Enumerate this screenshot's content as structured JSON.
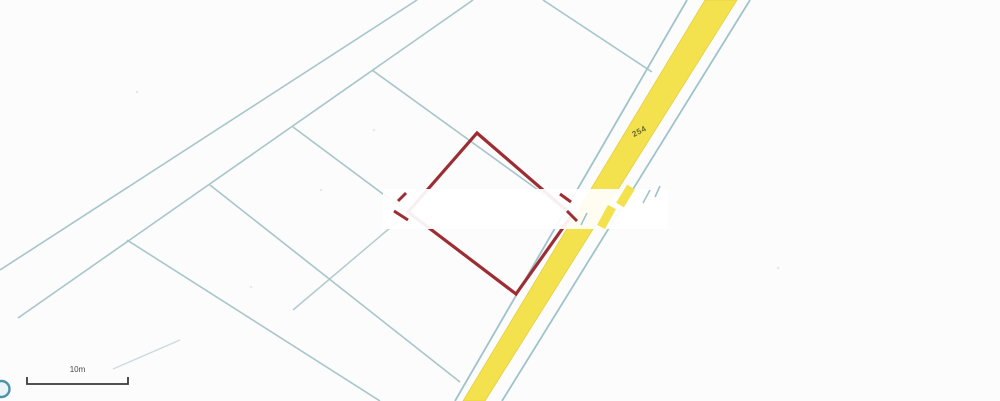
{
  "map": {
    "background": "#fcfcfc",
    "boundary_color": "#a4c3c8",
    "road": {
      "label": "254",
      "surface_color": "#F4E14E",
      "surface_edge_color": "#e4cf3c",
      "edge_line_color": "#9fc2cc",
      "surface_quad": [
        [
          705,
          0
        ],
        [
          737,
          0
        ],
        [
          485,
          401
        ],
        [
          463,
          401
        ]
      ],
      "left_edge_line": [
        687,
        0,
        455,
        401
      ],
      "right_edge_line": [
        750,
        0,
        502,
        401
      ]
    },
    "boundary_lines": [
      {
        "id": "long-parcel-line-1",
        "pts": [
          417,
          0,
          0,
          270
        ],
        "w": 1.6,
        "o": 0.95
      },
      {
        "id": "long-parcel-line-2",
        "pts": [
          473,
          0,
          18,
          318
        ],
        "w": 1.6,
        "o": 0.95
      },
      {
        "id": "long-parcel-line-2-fade",
        "pts": [
          180,
          340,
          113,
          369
        ],
        "w": 1.4,
        "o": 0.55
      },
      {
        "id": "divider-north",
        "pts": [
          543,
          0,
          652,
          72
        ],
        "w": 1.6,
        "o": 0.95
      },
      {
        "id": "divider-1",
        "pts": [
          372,
          70,
          563,
          208
        ],
        "w": 1.6,
        "o": 0.95
      },
      {
        "id": "divider-2",
        "pts": [
          293,
          127,
          516,
          293
        ],
        "w": 1.6,
        "o": 0.95
      },
      {
        "id": "divider-3",
        "pts": [
          210,
          185,
          460,
          382
        ],
        "w": 1.6,
        "o": 0.95
      },
      {
        "id": "divider-4",
        "pts": [
          127,
          240,
          380,
          401
        ],
        "w": 1.6,
        "o": 0.95
      },
      {
        "id": "cross-segment",
        "pts": [
          397,
          222,
          293,
          310
        ],
        "w": 1.5,
        "o": 0.85
      }
    ],
    "highlight_parcel": {
      "color": "#9C2E33",
      "stroke_width": 3.2,
      "points": "477,133 572,215 516,294 408,212"
    },
    "erasure_band": {
      "x": 383,
      "y": 189,
      "w": 285,
      "h": 40,
      "color": "#ffffff",
      "opacity": 0.93
    },
    "fragments": [
      {
        "color": "#9C2E33",
        "pts": [
          398,
          201,
          406,
          193
        ],
        "w": 3
      },
      {
        "color": "#9C2E33",
        "pts": [
          394,
          211,
          408,
          220
        ],
        "w": 3
      },
      {
        "color": "#9C2E33",
        "pts": [
          560,
          194,
          571,
          202
        ],
        "w": 3
      },
      {
        "color": "#9C2E33",
        "pts": [
          567,
          211,
          577,
          221
        ],
        "w": 3
      },
      {
        "color": "#F4E14E",
        "pts": [
          631,
          187,
          620,
          205
        ],
        "w": 9
      },
      {
        "color": "#F4E14E",
        "pts": [
          612,
          207,
          601,
          227
        ],
        "w": 9
      },
      {
        "color": "#9fc2cc",
        "pts": [
          587,
          213,
          581,
          225
        ],
        "w": 1.6
      },
      {
        "color": "#9fc2cc",
        "pts": [
          650,
          190,
          643,
          203
        ],
        "w": 1.6
      },
      {
        "color": "#9fc2cc",
        "pts": [
          660,
          186,
          655,
          197
        ],
        "w": 1.6
      }
    ],
    "scale_bar": {
      "label": "10m",
      "x1": 27,
      "x2": 128,
      "y": 384,
      "tick": 7,
      "color": "#3a3a3a"
    },
    "logo_circle": {
      "cx": 1.5,
      "cy": 389,
      "r": 8,
      "stroke": "#4b93a8",
      "fill": "#eaf5f7"
    },
    "noise_dots": [
      [
        137,
        92
      ],
      [
        374,
        130
      ],
      [
        321,
        190
      ],
      [
        251,
        287
      ],
      [
        778,
        268
      ]
    ]
  }
}
